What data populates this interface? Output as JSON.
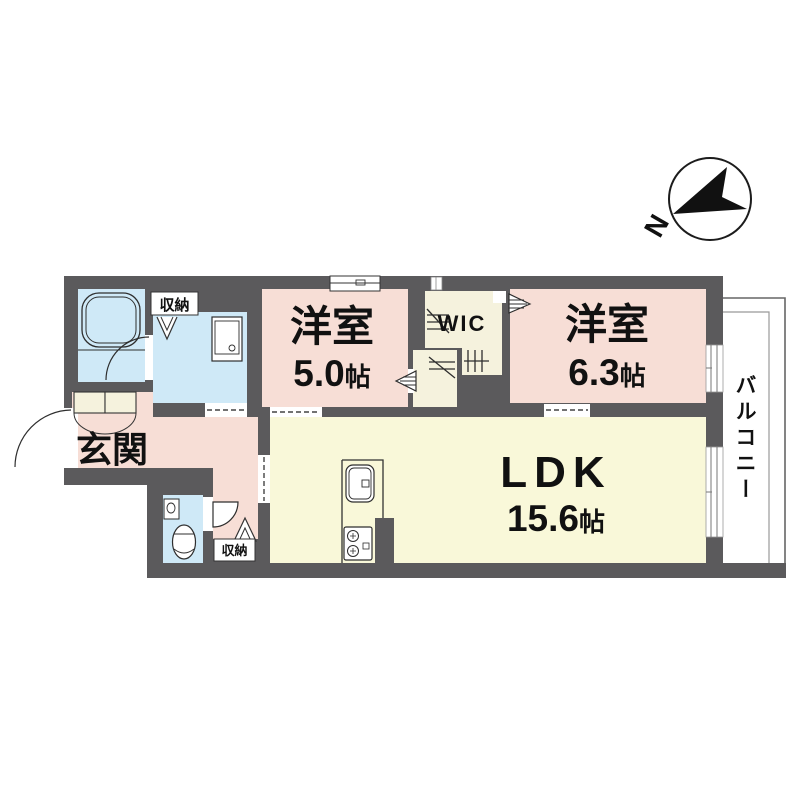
{
  "compass": {
    "north": "N"
  },
  "rooms": {
    "bedroom_small": {
      "label": "洋室",
      "area": "5.0",
      "unit": "帖"
    },
    "bedroom_large": {
      "label": "洋室",
      "area": "6.3",
      "unit": "帖"
    },
    "ldk": {
      "label": "LDK",
      "area": "15.6",
      "unit": "帖"
    },
    "entrance": {
      "label": "玄関"
    },
    "wic": {
      "label": "WIC"
    },
    "balcony": {
      "label": "バルコニー"
    },
    "storage_upper": {
      "label": "収納"
    },
    "storage_lower": {
      "label": "収納"
    }
  },
  "colors": {
    "wall": "#5b5a5c",
    "room_pink": "#f7ded6",
    "room_yellow": "#f9f8d9",
    "room_blue": "#cfe9f7",
    "closet_cream": "#f5f2dd",
    "balcony_line_outer": "#666666",
    "balcony_line_inner": "#999999",
    "outline": "#2e2e2e",
    "background": "#ffffff"
  }
}
